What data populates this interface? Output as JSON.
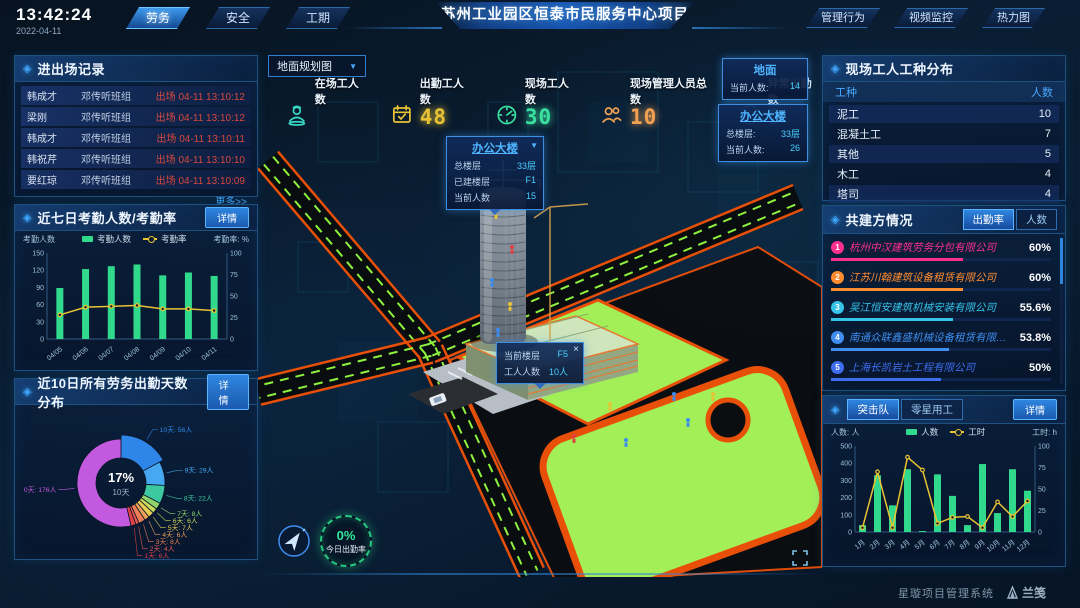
{
  "header": {
    "time": "13:42:24",
    "date": "2022-04-11",
    "nav_left": [
      {
        "label": "劳务",
        "active": true
      },
      {
        "label": "安全",
        "active": false
      },
      {
        "label": "工期",
        "active": false
      }
    ],
    "title": "苏州工业园区恒泰市民服务中心项目",
    "nav_right": [
      {
        "label": "管理行为"
      },
      {
        "label": "视频监控"
      },
      {
        "label": "热力图"
      }
    ]
  },
  "colors": {
    "accent": "#2f9bff",
    "bar_green": "#31d98c",
    "line_yellow": "#e8c335",
    "exit_red": "#d8483c",
    "field_green": "#a2ef58",
    "road_orange": "#e8500a"
  },
  "entry_exit": {
    "title": "进出场记录",
    "more": "更多>>",
    "rows": [
      {
        "name": "韩成才",
        "group": "邓传听班组",
        "event": "出场 04-11 13:10:12"
      },
      {
        "name": "梁刚",
        "group": "邓传听班组",
        "event": "出场 04-11 13:10:12"
      },
      {
        "name": "韩成才",
        "group": "邓传听班组",
        "event": "出场 04-11 13:10:11"
      },
      {
        "name": "韩祝芹",
        "group": "邓传听班组",
        "event": "出场 04-11 13:10:10"
      },
      {
        "name": "要红琼",
        "group": "邓传听班组",
        "event": "出场 04-11 13:10:09"
      }
    ]
  },
  "attendance_panel": {
    "title": "近七日考勤人数/考勤率",
    "detail": "详情"
  },
  "distribution_panel": {
    "title": "近10日所有劳务出勤天数分布",
    "detail": "详情"
  },
  "scene": {
    "view_select": "地面规划图",
    "stats": [
      {
        "icon": "worker",
        "label": "在场工人数",
        "value": "",
        "color": "#38d6c4"
      },
      {
        "icon": "calendar",
        "label": "出勤工人数",
        "value": "48",
        "color": "#e8c335"
      },
      {
        "icon": "gauge",
        "label": "现场工人数",
        "value": "30",
        "color": "#3ae0a0"
      },
      {
        "icon": "people",
        "label": "现场管理人员总数",
        "value": "10",
        "color": "#f0a050"
      },
      {
        "icon": "pulse",
        "label": "异常出勤数",
        "value": "0",
        "color": "#3aa6f0"
      }
    ],
    "ground_panel": {
      "title": "地面",
      "rows": [
        {
          "label": "当前人数:",
          "value": "14"
        }
      ]
    },
    "building_panel": {
      "title": "办公大楼",
      "rows": [
        {
          "label": "总楼层:",
          "value": "33层"
        },
        {
          "label": "当前人数:",
          "value": "26"
        }
      ]
    },
    "building_tooltip": {
      "title": "办公大楼",
      "rows": [
        {
          "label": "总楼层",
          "value": "33层"
        },
        {
          "label": "已建楼层",
          "value": "F1"
        },
        {
          "label": "当前人数",
          "value": "15"
        }
      ]
    },
    "floor_tooltip": {
      "close": "×",
      "rows": [
        {
          "label": "当前楼层",
          "value": "F5"
        },
        {
          "label": "工人人数",
          "value": "10人"
        }
      ]
    },
    "gauge": {
      "value": "0%",
      "label": "今日出勤率"
    }
  },
  "worker_types": {
    "title": "现场工人工种分布",
    "headers": [
      "工种",
      "人数"
    ],
    "rows": [
      {
        "type": "泥工",
        "count": "10"
      },
      {
        "type": "混凝土工",
        "count": "7"
      },
      {
        "type": "其他",
        "count": "5"
      },
      {
        "type": "木工",
        "count": "4"
      },
      {
        "type": "塔司",
        "count": "4"
      }
    ]
  },
  "partners": {
    "title": "共建方情况",
    "tabs": [
      {
        "label": "出勤率",
        "active": true
      },
      {
        "label": "人数",
        "active": false
      }
    ],
    "rows": [
      {
        "rank": "1",
        "name": "杭州中汉建筑劳务分包有限公司",
        "pct": "60%",
        "value": 60,
        "color": "#ff2f8e"
      },
      {
        "rank": "2",
        "name": "江苏川翰建筑设备租赁有限公司",
        "pct": "60%",
        "value": 60,
        "color": "#ff8c2e"
      },
      {
        "rank": "3",
        "name": "吴江恒安建筑机械安装有限公司",
        "pct": "55.6%",
        "value": 55.6,
        "color": "#35c3e8"
      },
      {
        "rank": "4",
        "name": "南通众联鑫盛机械设备租赁有限公司",
        "pct": "53.8%",
        "value": 53.8,
        "color": "#3f8ef0"
      },
      {
        "rank": "5",
        "name": "上海长凯岩土工程有限公司",
        "pct": "50%",
        "value": 50,
        "color": "#3f6df0"
      },
      {
        "rank": "6",
        "name": "江苏法诺建筑安装工程有限公司",
        "pct": "35.4%",
        "value": 35.4,
        "color": "#7e5af0"
      }
    ]
  },
  "assault_panel": {
    "tabs": [
      {
        "label": "突击队",
        "active": true
      },
      {
        "label": "零星用工",
        "active": false
      }
    ],
    "detail": "详情"
  },
  "footer": {
    "system": "星璇项目管理系统",
    "logo": "兰笺"
  },
  "chart_data": [
    {
      "id": "attendance7",
      "type": "bar+line",
      "title": "近七日考勤人数/考勤率",
      "categories": [
        "04/05",
        "04/06",
        "04/07",
        "04/08",
        "04/09",
        "04/10",
        "04/11"
      ],
      "series": [
        {
          "name": "考勤人数",
          "type": "bar",
          "axis": "left",
          "color": "#31d98c",
          "values": [
            89,
            122,
            127,
            130,
            111,
            116,
            110
          ]
        },
        {
          "name": "考勤率",
          "type": "line",
          "axis": "right",
          "color": "#e8c335",
          "values": [
            28,
            37,
            38,
            39,
            35,
            35,
            33
          ]
        }
      ],
      "left_axis": {
        "label": "考勤人数",
        "max": 150,
        "ticks": [
          0,
          30,
          60,
          90,
          120,
          150
        ]
      },
      "right_axis": {
        "label": "考勤率: %",
        "max": 100,
        "ticks": [
          0,
          25,
          50,
          75,
          100
        ]
      },
      "legend_position": "top",
      "grid": false
    },
    {
      "id": "attendance_days",
      "type": "pie",
      "title": "近10日所有劳务出勤天数分布",
      "center": {
        "pct": "17%",
        "label": "10天"
      },
      "slices": [
        {
          "label": "10天",
          "count": "56人",
          "value": 56,
          "color": "#2e86e8"
        },
        {
          "label": "9天",
          "count": "29人",
          "value": 29,
          "color": "#45a8f0"
        },
        {
          "label": "8天",
          "count": "22人",
          "value": 22,
          "color": "#3cc9a2"
        },
        {
          "label": "7天",
          "count": "8人",
          "value": 8,
          "color": "#8fd26a"
        },
        {
          "label": "6天",
          "count": "6人",
          "value": 6,
          "color": "#c8d95e"
        },
        {
          "label": "5天",
          "count": "7人",
          "value": 7,
          "color": "#e8cb52"
        },
        {
          "label": "4天",
          "count": "6人",
          "value": 6,
          "color": "#eda05a"
        },
        {
          "label": "3天",
          "count": "8人",
          "value": 8,
          "color": "#ee7e56"
        },
        {
          "label": "2天",
          "count": "4人",
          "value": 4,
          "color": "#e85a52"
        },
        {
          "label": "1天",
          "count": "6人",
          "value": 6,
          "color": "#e04048"
        },
        {
          "label": "0天",
          "count": "176人",
          "value": 176,
          "color": "#c25ae0"
        }
      ]
    },
    {
      "id": "assault",
      "type": "bar+line",
      "title": "突击队",
      "categories": [
        "1月",
        "2月",
        "3月",
        "4月",
        "5月",
        "6月",
        "7月",
        "8月",
        "9月",
        "10月",
        "11月",
        "12月"
      ],
      "series": [
        {
          "name": "人数",
          "type": "bar",
          "axis": "left",
          "color": "#31d98c",
          "values": [
            40,
            330,
            155,
            365,
            5,
            335,
            210,
            40,
            395,
            110,
            365,
            240
          ]
        },
        {
          "name": "工时",
          "type": "line",
          "axis": "right",
          "color": "#e8c335",
          "values": [
            5,
            70,
            5,
            87,
            72,
            10,
            17,
            18,
            5,
            35,
            18,
            36
          ]
        }
      ],
      "left_axis": {
        "label": "人数: 人",
        "max": 500,
        "ticks": [
          0,
          100,
          200,
          300,
          400,
          500
        ]
      },
      "right_axis": {
        "label": "工时: h",
        "max": 100,
        "ticks": [
          0,
          25,
          50,
          75,
          100
        ]
      },
      "legend_position": "top",
      "grid": false
    }
  ]
}
